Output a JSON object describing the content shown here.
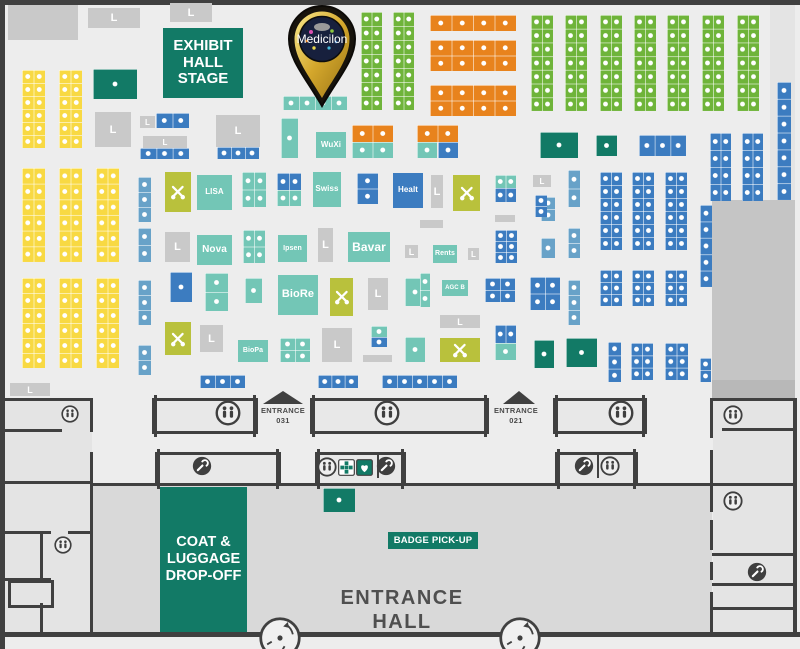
{
  "logo": {
    "label": "Medicilon"
  },
  "texts": {
    "stage": [
      "EXHIBIT",
      "HALL",
      "STAGE"
    ],
    "coat": [
      "COAT &",
      "LUGGAGE",
      "DROP-OFF"
    ],
    "badge": "BADGE PICK-UP",
    "hall": [
      "ENTRANCE",
      "HALL"
    ],
    "ent031": [
      "ENTRANCE",
      "031"
    ],
    "ent021": [
      "ENTRANCE",
      "021"
    ]
  },
  "palette": {
    "yellow": "#f8d943",
    "green": "#6fb43a",
    "green2": "#127a66",
    "orange": "#e8831d",
    "teal": "#73c6b6",
    "blue": "#3c7cc0",
    "lightblue": "#68a2c8",
    "olive": "#b9c13c",
    "gray": "#c9c9c9",
    "wall": "#404040",
    "floor": "#ededed",
    "hallfloor": "#d9d9d9",
    "label_text": "#4f4f4f"
  },
  "areas": [
    [
      92,
      486,
      620,
      146,
      "#d9d9d9"
    ],
    [
      5,
      398,
      87,
      234,
      "#e4e4e4"
    ],
    [
      713,
      398,
      80,
      234,
      "#e4e4e4"
    ],
    [
      770,
      5,
      25,
      390,
      "#e4e4e4"
    ],
    [
      712,
      200,
      83,
      180,
      "#c5c5c5"
    ],
    [
      712,
      380,
      83,
      18,
      "#b8b8b8"
    ]
  ],
  "booths": [
    [
      8,
      5,
      70,
      35,
      "gray",
      "p"
    ],
    [
      88,
      8,
      52,
      20,
      "gray",
      "L"
    ],
    [
      170,
      3,
      42,
      19,
      "gray",
      "L"
    ],
    [
      22,
      70,
      23,
      78,
      "yellow",
      "d",
      [
        2,
        6
      ]
    ],
    [
      59,
      70,
      23,
      78,
      "yellow",
      "d",
      [
        2,
        6
      ]
    ],
    [
      93,
      69,
      44,
      30,
      "green2",
      "d",
      [
        1,
        1
      ]
    ],
    [
      95,
      112,
      36,
      35,
      "gray",
      "L"
    ],
    [
      22,
      168,
      23,
      94,
      "yellow",
      "d",
      [
        2,
        6
      ]
    ],
    [
      59,
      168,
      23,
      94,
      "yellow",
      "d",
      [
        2,
        6
      ]
    ],
    [
      96,
      168,
      23,
      94,
      "yellow",
      "d",
      [
        2,
        6
      ]
    ],
    [
      22,
      278,
      23,
      90,
      "yellow",
      "d",
      [
        2,
        6
      ]
    ],
    [
      59,
      278,
      23,
      90,
      "yellow",
      "d",
      [
        2,
        6
      ]
    ],
    [
      96,
      278,
      23,
      90,
      "yellow",
      "d",
      [
        2,
        6
      ]
    ],
    [
      10,
      383,
      40,
      13,
      "gray",
      "L"
    ],
    [
      138,
      177,
      13,
      45,
      "lightblue",
      "d",
      [
        1,
        3
      ]
    ],
    [
      138,
      228,
      13,
      34,
      "lightblue",
      "d",
      [
        1,
        2
      ]
    ],
    [
      138,
      280,
      13,
      45,
      "lightblue",
      "d",
      [
        1,
        3
      ]
    ],
    [
      138,
      345,
      13,
      30,
      "lightblue",
      "d",
      [
        1,
        2
      ]
    ],
    [
      140,
      116,
      15,
      12,
      "gray",
      "L"
    ],
    [
      156,
      113,
      33,
      15,
      "blue",
      "d",
      [
        2,
        1
      ]
    ],
    [
      143,
      136,
      44,
      12,
      "gray",
      "L"
    ],
    [
      140,
      148,
      49,
      11,
      "blue",
      "d",
      [
        3,
        1
      ]
    ],
    [
      216,
      115,
      44,
      32,
      "gray",
      "L"
    ],
    [
      217,
      147,
      42,
      12,
      "blue",
      "d",
      [
        3,
        1
      ]
    ],
    [
      281,
      118,
      17,
      40,
      "teal",
      "d",
      [
        1,
        1
      ]
    ],
    [
      283,
      96,
      64,
      14,
      "teal",
      "d",
      [
        4,
        1
      ]
    ],
    [
      316,
      132,
      30,
      26,
      "teal",
      "t",
      "WuXi",
      8
    ],
    [
      352,
      125,
      41,
      17,
      "orange",
      "d",
      [
        2,
        1
      ]
    ],
    [
      352,
      142,
      41,
      16,
      "teal",
      "d",
      [
        2,
        1
      ]
    ],
    [
      417,
      125,
      41,
      17,
      "orange",
      "d",
      [
        2,
        1
      ]
    ],
    [
      417,
      142,
      20,
      16,
      "teal",
      "d",
      [
        1,
        1
      ]
    ],
    [
      438,
      142,
      20,
      16,
      "blue",
      "d",
      [
        1,
        1
      ]
    ],
    [
      361,
      12,
      21,
      98,
      "green",
      "d",
      [
        2,
        7
      ]
    ],
    [
      393,
      12,
      21,
      98,
      "green",
      "d",
      [
        2,
        7
      ]
    ],
    [
      430,
      15,
      86,
      16,
      "orange",
      "d",
      [
        4,
        1
      ]
    ],
    [
      430,
      40,
      86,
      31,
      "orange",
      "d",
      [
        4,
        2
      ]
    ],
    [
      430,
      85,
      86,
      31,
      "orange",
      "d",
      [
        4,
        2
      ]
    ],
    [
      531,
      15,
      22,
      96,
      "green",
      "d",
      [
        2,
        7
      ]
    ],
    [
      565,
      15,
      22,
      96,
      "green",
      "d",
      [
        2,
        7
      ]
    ],
    [
      600,
      15,
      22,
      96,
      "green",
      "d",
      [
        2,
        7
      ]
    ],
    [
      634,
      15,
      22,
      96,
      "green",
      "d",
      [
        2,
        7
      ]
    ],
    [
      667,
      15,
      22,
      96,
      "green",
      "d",
      [
        2,
        7
      ]
    ],
    [
      702,
      15,
      22,
      96,
      "green",
      "d",
      [
        2,
        7
      ]
    ],
    [
      737,
      15,
      22,
      96,
      "green",
      "d",
      [
        2,
        7
      ]
    ],
    [
      777,
      82,
      14,
      118,
      "blue",
      "d",
      [
        1,
        7
      ]
    ],
    [
      540,
      132,
      38,
      26,
      "green2",
      "d",
      [
        1,
        1
      ]
    ],
    [
      596,
      135,
      21,
      21,
      "green2",
      "d",
      [
        1,
        1
      ]
    ],
    [
      639,
      135,
      47,
      21,
      "blue",
      "d",
      [
        3,
        1
      ]
    ],
    [
      710,
      133,
      21,
      68,
      "blue",
      "d",
      [
        2,
        4
      ]
    ],
    [
      742,
      133,
      21,
      68,
      "blue",
      "d",
      [
        2,
        4
      ]
    ],
    [
      541,
      197,
      14,
      24,
      "lightblue",
      "d",
      [
        1,
        2
      ]
    ],
    [
      541,
      238,
      14,
      20,
      "lightblue",
      "d",
      [
        1,
        1
      ]
    ],
    [
      541,
      278,
      14,
      15,
      "teal",
      "d",
      [
        1,
        1
      ]
    ],
    [
      541,
      293,
      14,
      15,
      "blue",
      "d",
      [
        1,
        1
      ]
    ],
    [
      568,
      170,
      12,
      37,
      "lightblue",
      "d",
      [
        1,
        2
      ]
    ],
    [
      568,
      228,
      12,
      30,
      "lightblue",
      "d",
      [
        1,
        2
      ]
    ],
    [
      568,
      280,
      12,
      45,
      "lightblue",
      "d",
      [
        1,
        3
      ]
    ],
    [
      600,
      172,
      22,
      78,
      "blue",
      "d",
      [
        2,
        6
      ]
    ],
    [
      632,
      172,
      22,
      78,
      "blue",
      "d",
      [
        2,
        6
      ]
    ],
    [
      665,
      172,
      22,
      78,
      "blue",
      "d",
      [
        2,
        6
      ]
    ],
    [
      600,
      270,
      22,
      36,
      "blue",
      "d",
      [
        2,
        3
      ]
    ],
    [
      632,
      270,
      22,
      36,
      "blue",
      "d",
      [
        2,
        3
      ]
    ],
    [
      665,
      270,
      22,
      36,
      "blue",
      "d",
      [
        2,
        3
      ]
    ],
    [
      700,
      205,
      12,
      82,
      "blue",
      "d",
      [
        1,
        5
      ]
    ],
    [
      608,
      342,
      13,
      40,
      "blue",
      "d",
      [
        1,
        3
      ]
    ],
    [
      631,
      343,
      22,
      37,
      "blue",
      "d",
      [
        2,
        3
      ]
    ],
    [
      665,
      343,
      23,
      37,
      "blue",
      "d",
      [
        2,
        3
      ]
    ],
    [
      700,
      358,
      11,
      24,
      "blue",
      "d",
      [
        1,
        2
      ]
    ],
    [
      534,
      340,
      20,
      28,
      "green2",
      "d",
      [
        1,
        1
      ]
    ],
    [
      566,
      338,
      31,
      29,
      "green2",
      "d",
      [
        1,
        1
      ]
    ],
    [
      165,
      172,
      26,
      40,
      "olive",
      "X"
    ],
    [
      197,
      175,
      35,
      35,
      "teal",
      "t",
      "LISA",
      8
    ],
    [
      242,
      172,
      24,
      35,
      "teal",
      "d",
      [
        2,
        2
      ]
    ],
    [
      277,
      173,
      24,
      17,
      "blue",
      "d",
      [
        2,
        1
      ]
    ],
    [
      277,
      190,
      24,
      16,
      "teal",
      "d",
      [
        2,
        1
      ]
    ],
    [
      313,
      172,
      28,
      35,
      "teal",
      "t",
      "Swiss",
      8
    ],
    [
      357,
      173,
      21,
      31,
      "blue",
      "d",
      [
        1,
        2
      ]
    ],
    [
      393,
      173,
      30,
      35,
      "blue",
      "t",
      "Healt",
      8
    ],
    [
      431,
      175,
      12,
      33,
      "gray",
      "L"
    ],
    [
      453,
      175,
      27,
      36,
      "olive",
      "X"
    ],
    [
      495,
      175,
      21,
      13,
      "teal",
      "d",
      [
        2,
        1
      ]
    ],
    [
      495,
      188,
      21,
      14,
      "blue",
      "d",
      [
        2,
        1
      ]
    ],
    [
      533,
      175,
      18,
      12,
      "gray",
      "L"
    ],
    [
      535,
      195,
      12,
      22,
      "blue",
      "d",
      [
        1,
        2
      ]
    ],
    [
      495,
      215,
      20,
      7,
      "gray",
      "p"
    ],
    [
      420,
      220,
      23,
      8,
      "gray",
      "p"
    ],
    [
      165,
      232,
      25,
      30,
      "gray",
      "L"
    ],
    [
      197,
      235,
      35,
      30,
      "teal",
      "t",
      "Nova",
      10
    ],
    [
      243,
      230,
      22,
      33,
      "teal",
      "d",
      [
        2,
        2
      ]
    ],
    [
      278,
      235,
      29,
      27,
      "teal",
      "t",
      "Ipsen",
      7
    ],
    [
      318,
      228,
      15,
      34,
      "gray",
      "L"
    ],
    [
      348,
      232,
      42,
      30,
      "teal",
      "t",
      "Bavar",
      12
    ],
    [
      405,
      245,
      13,
      13,
      "gray",
      "L"
    ],
    [
      433,
      245,
      24,
      18,
      "teal",
      "t",
      "Rents",
      7
    ],
    [
      468,
      248,
      11,
      12,
      "gray",
      "L"
    ],
    [
      495,
      230,
      22,
      33,
      "blue",
      "d",
      [
        2,
        3
      ]
    ],
    [
      170,
      272,
      22,
      30,
      "blue",
      "d",
      [
        1,
        1
      ]
    ],
    [
      205,
      273,
      23,
      38,
      "teal",
      "d",
      [
        1,
        2
      ]
    ],
    [
      245,
      278,
      17,
      25,
      "teal",
      "d",
      [
        1,
        1
      ]
    ],
    [
      278,
      275,
      40,
      40,
      "teal",
      "t",
      "BioRe",
      11
    ],
    [
      330,
      278,
      23,
      38,
      "olive",
      "X"
    ],
    [
      368,
      278,
      20,
      32,
      "gray",
      "L"
    ],
    [
      405,
      278,
      20,
      28,
      "teal",
      "d",
      [
        1,
        1
      ]
    ],
    [
      420,
      273,
      10,
      34,
      "teal",
      "d",
      [
        1,
        2
      ]
    ],
    [
      442,
      280,
      26,
      16,
      "teal",
      "t",
      "AGC B",
      6
    ],
    [
      485,
      278,
      30,
      24,
      "blue",
      "d",
      [
        2,
        2
      ]
    ],
    [
      530,
      277,
      30,
      33,
      "blue",
      "d",
      [
        2,
        2
      ]
    ],
    [
      165,
      322,
      26,
      33,
      "olive",
      "X"
    ],
    [
      200,
      325,
      23,
      27,
      "gray",
      "L"
    ],
    [
      238,
      340,
      30,
      22,
      "teal",
      "t",
      "BioPa",
      7
    ],
    [
      280,
      338,
      30,
      24,
      "teal",
      "d",
      [
        2,
        2
      ]
    ],
    [
      322,
      328,
      30,
      34,
      "gray",
      "L"
    ],
    [
      371,
      326,
      16,
      11,
      "teal",
      "d",
      [
        1,
        1
      ]
    ],
    [
      371,
      337,
      16,
      10,
      "blue",
      "d",
      [
        1,
        1
      ]
    ],
    [
      363,
      355,
      29,
      7,
      "gray",
      "p"
    ],
    [
      405,
      337,
      20,
      25,
      "teal",
      "d",
      [
        1,
        1
      ]
    ],
    [
      440,
      315,
      40,
      13,
      "gray",
      "L"
    ],
    [
      440,
      338,
      40,
      24,
      "olive",
      "X"
    ],
    [
      495,
      325,
      21,
      18,
      "blue",
      "d",
      [
        2,
        1
      ]
    ],
    [
      495,
      343,
      21,
      17,
      "teal",
      "d",
      [
        1,
        1
      ]
    ],
    [
      200,
      375,
      45,
      13,
      "blue",
      "d",
      [
        3,
        1
      ]
    ],
    [
      318,
      375,
      40,
      13,
      "blue",
      "d",
      [
        3,
        1
      ]
    ],
    [
      382,
      375,
      75,
      13,
      "blue",
      "d",
      [
        5,
        1
      ]
    ],
    [
      323,
      488,
      32,
      24,
      "green2",
      "d",
      [
        1,
        1
      ]
    ]
  ],
  "structures": [
    [
      152,
      398,
      100,
      30
    ],
    [
      310,
      398,
      173,
      30
    ],
    [
      553,
      398,
      88,
      30
    ],
    [
      155,
      452,
      120,
      28
    ],
    [
      315,
      452,
      85,
      28
    ],
    [
      555,
      452,
      77,
      28
    ]
  ],
  "walls": [
    [
      0,
      0,
      800,
      5
    ],
    [
      0,
      0,
      5,
      649
    ],
    [
      0,
      632,
      800,
      5
    ],
    [
      92,
      483,
      620,
      3
    ],
    [
      5,
      398,
      88,
      3
    ],
    [
      5,
      429,
      57,
      3
    ],
    [
      5,
      481,
      87,
      3
    ],
    [
      90,
      398,
      3,
      34
    ],
    [
      90,
      452,
      3,
      180
    ],
    [
      5,
      531,
      46,
      3
    ],
    [
      68,
      531,
      25,
      3
    ],
    [
      40,
      531,
      3,
      50
    ],
    [
      5,
      578,
      46,
      3
    ],
    [
      40,
      603,
      3,
      29
    ],
    [
      710,
      398,
      85,
      3
    ],
    [
      793,
      398,
      4,
      234
    ],
    [
      710,
      398,
      3,
      40
    ],
    [
      710,
      450,
      3,
      62
    ],
    [
      710,
      520,
      3,
      30
    ],
    [
      710,
      562,
      3,
      18
    ],
    [
      710,
      592,
      3,
      40
    ],
    [
      722,
      428,
      73,
      3
    ],
    [
      712,
      483,
      83,
      3
    ],
    [
      712,
      553,
      83,
      3
    ],
    [
      712,
      583,
      83,
      3
    ],
    [
      712,
      607,
      83,
      3
    ],
    [
      377,
      454,
      2,
      24
    ],
    [
      597,
      454,
      2,
      24
    ]
  ],
  "outlines": [
    [
      8,
      580,
      40,
      22
    ]
  ],
  "icons": [
    [
      228,
      413,
      26,
      "restroom"
    ],
    [
      387,
      413,
      26,
      "restroom"
    ],
    [
      621,
      413,
      26,
      "restroom"
    ],
    [
      70,
      414,
      18,
      "restroom"
    ],
    [
      733,
      415,
      20,
      "restroom"
    ],
    [
      733,
      501,
      20,
      "restroom"
    ],
    [
      63,
      545,
      18,
      "restroom"
    ],
    [
      327,
      467,
      20,
      "restroom"
    ],
    [
      610,
      466,
      20,
      "restroom"
    ],
    [
      202,
      466,
      20,
      "service"
    ],
    [
      386,
      466,
      20,
      "service"
    ],
    [
      584,
      466,
      20,
      "service"
    ],
    [
      757,
      572,
      20,
      "service"
    ],
    [
      346,
      467,
      17,
      "firstaid"
    ],
    [
      364,
      467,
      17,
      "aed"
    ]
  ],
  "arrows": [
    [
      263,
      391,
      40,
      13
    ],
    [
      503,
      391,
      33,
      13
    ]
  ],
  "doors": [
    [
      280,
      638,
      22
    ],
    [
      520,
      638,
      22
    ]
  ]
}
